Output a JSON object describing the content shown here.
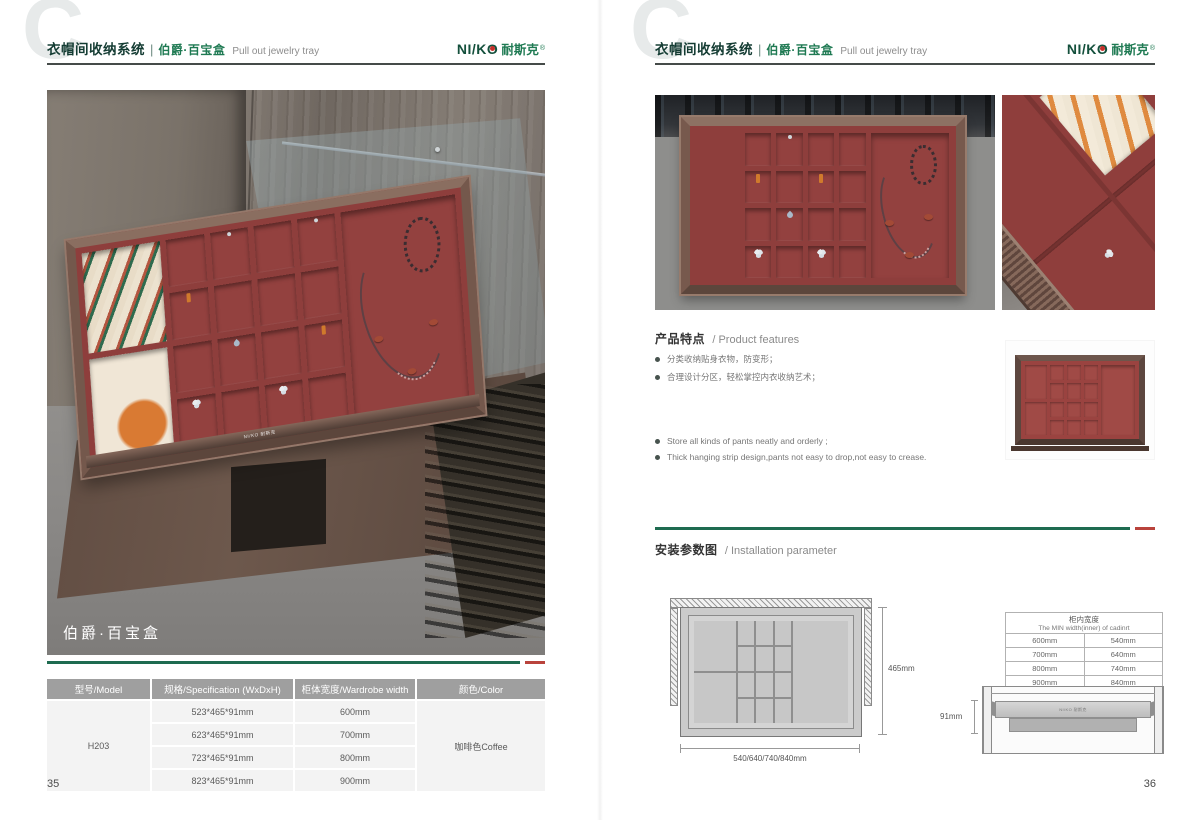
{
  "brand": {
    "logo_text": "NI/KO",
    "logo_cn": "耐斯克",
    "reg": "®",
    "tray_logo": "NI/KO 耐斯克"
  },
  "header": {
    "watermark": "C",
    "title_cn": "衣帽间收纳系统",
    "divider": "|",
    "subtitle_cn": "伯爵·百宝盒",
    "subtitle_en": "Pull out jewelry tray"
  },
  "colors": {
    "accent_green": "#1e6b50",
    "accent_red": "#b9433c",
    "tray_red": "#8e3e3c",
    "frame_brown": "#74584c"
  },
  "left_page": {
    "page_number": "35",
    "photo_label": "伯爵·百宝盒",
    "table": {
      "headers": [
        "型号/Model",
        "规格/Specification (WxDxH)",
        "柜体宽度/Wardrobe width",
        "颜色/Color"
      ],
      "model": "H203",
      "color": "咖啡色Coffee",
      "rows": [
        {
          "spec": "523*465*91mm",
          "width": "600mm"
        },
        {
          "spec": "623*465*91mm",
          "width": "700mm"
        },
        {
          "spec": "723*465*91mm",
          "width": "800mm"
        },
        {
          "spec": "823*465*91mm",
          "width": "900mm"
        }
      ]
    }
  },
  "right_page": {
    "page_number": "36",
    "features": {
      "title_cn": "产品特点",
      "title_en": "/ Product features",
      "bullets_cn": [
        "分类收纳贴身衣物，防变形；",
        "合理设计分区，轻松掌控内衣收纳艺术；"
      ],
      "bullets_en": [
        "Store all kinds of pants neatly and orderly ;",
        "Thick hanging strip design,pants not easy to drop,not easy to crease."
      ]
    },
    "installation": {
      "title_cn": "安装参数图",
      "title_en": "/ Installation parameter",
      "top_view": {
        "height_label": "465mm",
        "width_label": "540/640/740/840mm"
      },
      "side_view": {
        "height_label": "91mm"
      },
      "width_table": {
        "title_cn": "柜内宽度",
        "title_en": "The MIN width(inner) of cadinrt",
        "rows": [
          [
            "600mm",
            "540mm"
          ],
          [
            "700mm",
            "640mm"
          ],
          [
            "800mm",
            "740mm"
          ],
          [
            "900mm",
            "840mm"
          ]
        ]
      }
    }
  }
}
